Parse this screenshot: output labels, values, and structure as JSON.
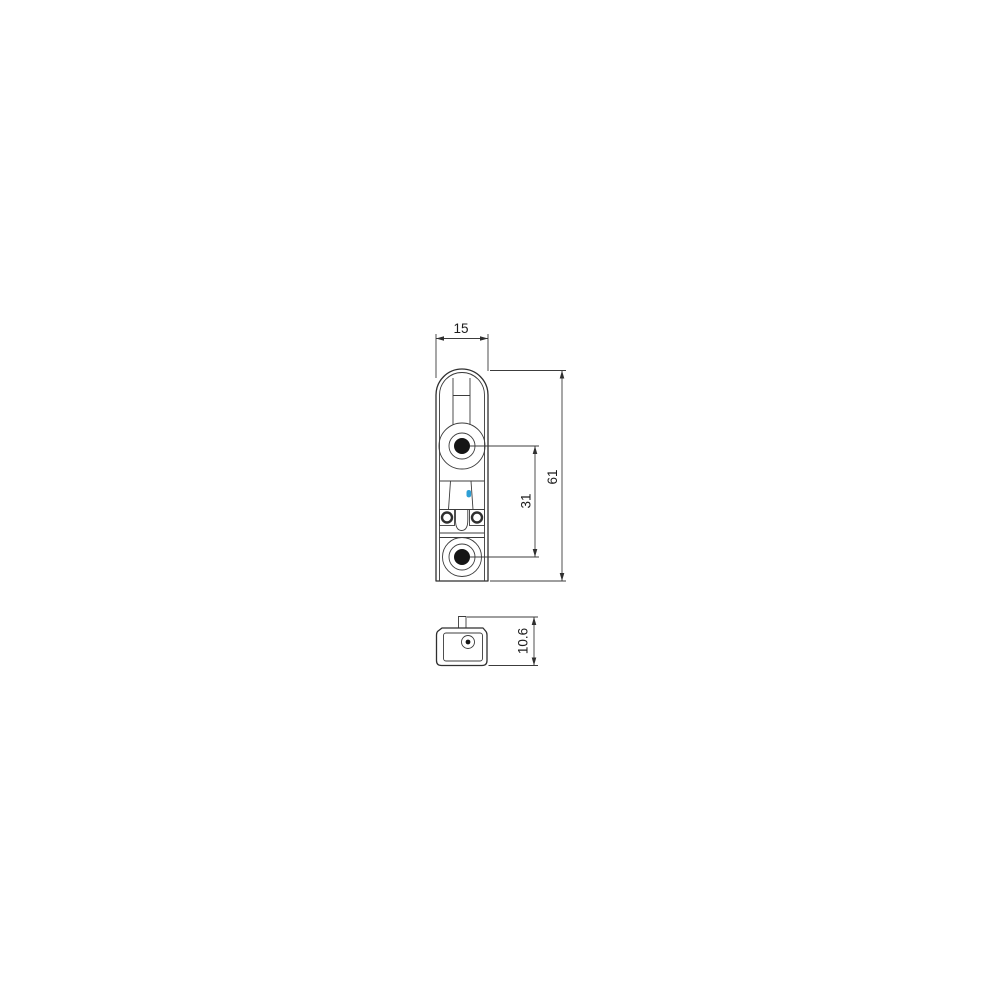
{
  "drawing": {
    "kind": "technical-dimension-drawing",
    "dimensions": {
      "width": {
        "label": "15"
      },
      "height": {
        "label": "61"
      },
      "hole_spacing": {
        "label": "31"
      },
      "depth": {
        "label": "10.6"
      }
    },
    "colors": {
      "line": "#2f2f2f",
      "background": "#ffffff",
      "marker": "#2d9fd6",
      "hole_fill": "#151515"
    }
  }
}
